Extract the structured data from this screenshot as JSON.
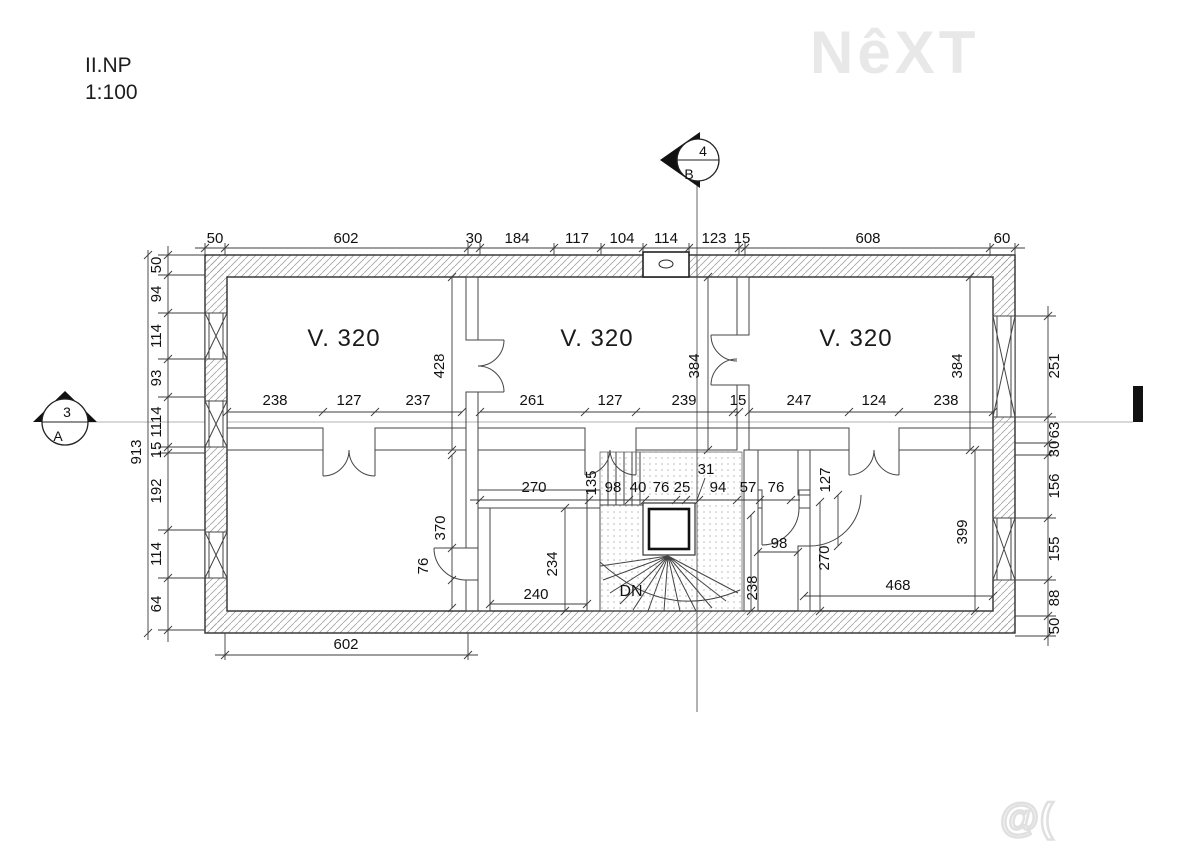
{
  "header": {
    "floor_label": "II.NP",
    "scale_label": "1:100"
  },
  "watermarks": {
    "logo_text": "NêXT",
    "site_text": "@( Bazos.cz"
  },
  "plan": {
    "room_labels": [
      "V. 320",
      "V. 320",
      "V. 320"
    ],
    "stair_down_label": "DN",
    "markers": {
      "top": {
        "number": "4",
        "letter": "B"
      },
      "left": {
        "number": "3",
        "letter": "A"
      }
    }
  },
  "dims": {
    "top": [
      "50",
      "602",
      "30",
      "184",
      "117",
      "104",
      "114",
      "123",
      "15",
      "608",
      "60"
    ],
    "left": [
      "50",
      "94",
      "114",
      "93",
      "1114",
      "15",
      "192",
      "114",
      "64"
    ],
    "left_overall": "913",
    "right": [
      "251",
      "63",
      "30",
      "156",
      "155",
      "88",
      "50"
    ],
    "bottom_overall": "602",
    "room1_w": [
      "238",
      "127",
      "237"
    ],
    "room1_d": "428",
    "room2_w": [
      "261",
      "127",
      "239",
      "15"
    ],
    "room2_d": "384",
    "room3_w": [
      "247",
      "124",
      "238"
    ],
    "room3_d": "384",
    "hall": [
      "270",
      "135",
      "98",
      "40",
      "76",
      "25",
      "31",
      "94",
      "57",
      "76"
    ],
    "small_room": {
      "w": "240",
      "d": "234",
      "wall": "370",
      "door": "76"
    },
    "right_zone": {
      "door": "127",
      "wc_w": "98",
      "wc_d": "270",
      "shaft": "238",
      "room_w": "468",
      "room_d": "399"
    }
  },
  "colors": {
    "wall_line": "#2e2e2e",
    "hatch": "#a3a3a3",
    "dim_line": "#3c3c3c",
    "text": "#111111",
    "watermark": "#e8e8e8"
  }
}
